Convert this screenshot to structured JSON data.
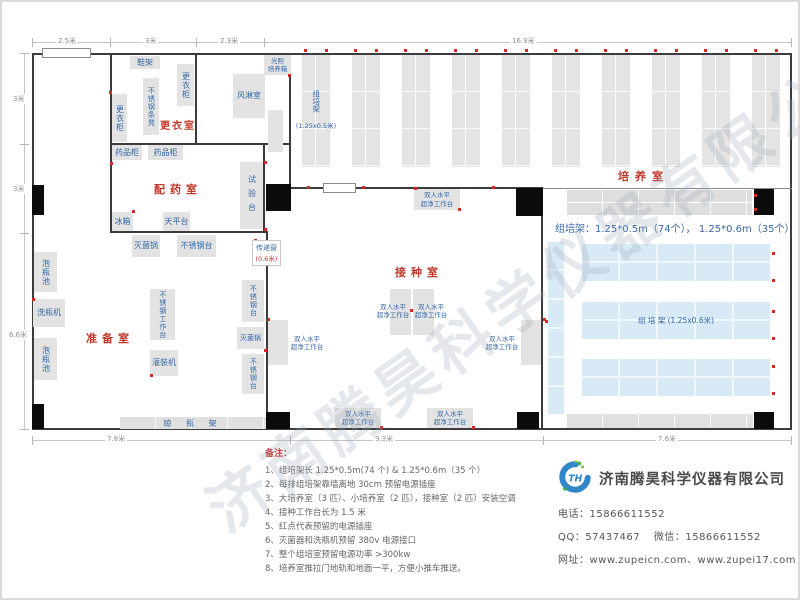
{
  "watermark": "济南腾昊科学仪器有限公司",
  "dimensions": {
    "top": [
      "2.5米",
      "3米",
      "2.3米",
      "16.9米"
    ],
    "left": [
      "3米",
      "3米",
      "6.6米"
    ],
    "bottom": [
      "7.8米",
      "9.3米",
      "7.6米"
    ]
  },
  "rooms": {
    "changing_room": "更衣室",
    "dispensing_room": "配药室",
    "prep_room": "准备室",
    "inoculation_room": "接种室",
    "culture_room": "培养室"
  },
  "equipment": {
    "shoe_rack": "鞋架",
    "locker": "更衣柜",
    "ss_slat_bench": "不锈钢条凳",
    "air_shower": "风淋室",
    "light_incubator": "光照\n培养箱",
    "medicine_cabinet": "药品柜",
    "test_bench": "试验台",
    "fridge": "冰箱",
    "balance_table": "天平台",
    "sterilizer": "灭菌锅",
    "ss_table": "不锈钢台",
    "pass_window": "传递窗",
    "pass_window_size": "(0.6米)",
    "bottle_soak_pool": "泡瓶池",
    "bottle_washer": "洗瓶机",
    "ss_worktable": "不锈钢工作台",
    "filling_machine": "灌装机",
    "bottle_drying_rack": "晾 瓶 架",
    "clean_bench": "双人水平\n超净工作台"
  },
  "culture": {
    "top_rack_count": 10,
    "rack_label": "组培架",
    "rack_size_small": "(1.25x0.5米)",
    "blue_rack_label": "组  培  架 (1.25x0.6米)",
    "summary": "组培架：1.25*0.5m（74个）， 1.25*0.6m（35个）"
  },
  "outlet_dots": [
    [
      252,
      237
    ],
    [
      274,
      258
    ],
    [
      262,
      159
    ],
    [
      262,
      226
    ],
    [
      130,
      208
    ],
    [
      107,
      89
    ],
    [
      30,
      296
    ],
    [
      148,
      372
    ],
    [
      262,
      347
    ],
    [
      412,
      185
    ],
    [
      456,
      206
    ],
    [
      408,
      307
    ],
    [
      378,
      424
    ],
    [
      470,
      424
    ],
    [
      265,
      316
    ],
    [
      541,
      316
    ],
    [
      305,
      184
    ],
    [
      360,
      184
    ],
    [
      490,
      184
    ],
    [
      543,
      318
    ],
    [
      752,
      192
    ],
    [
      752,
      206
    ],
    [
      770,
      250
    ],
    [
      770,
      277
    ],
    [
      770,
      308
    ],
    [
      770,
      335
    ],
    [
      770,
      363
    ],
    [
      770,
      390
    ],
    [
      286,
      72
    ],
    [
      108,
      160
    ]
  ],
  "notes": {
    "title": "备注：",
    "items": [
      "1、组培架长 1.25*0.5m(74 个) & 1.25*0.6m（35 个）",
      "2、每排组培架靠墙离地 30cm 预留电源插座",
      "3、大培养室（3 匹）、小培养室（2 匹），接种室（2 匹）安装空调",
      "4、接种工作台长为 1.5 米",
      "5、红点代表预留的电源插座",
      "6、灭菌器和洗瓶机预留 380v 电源接口",
      "7、整个组培室预留电源功率 >300kw",
      "8、培养室推拉门地轨和地面一平，方便小推车推送。"
    ]
  },
  "company": {
    "logo_text": "TH",
    "name": "济南腾昊科学仪器有限公司",
    "phone_label": "电话：",
    "phone": "15866611552",
    "qq_label": "QQ：",
    "qq": "57437467",
    "wechat_label": "微信：",
    "wechat": "15866611552",
    "web_label": "网址：",
    "websites": "www.zupeicn.com、www.zupei17.com"
  }
}
